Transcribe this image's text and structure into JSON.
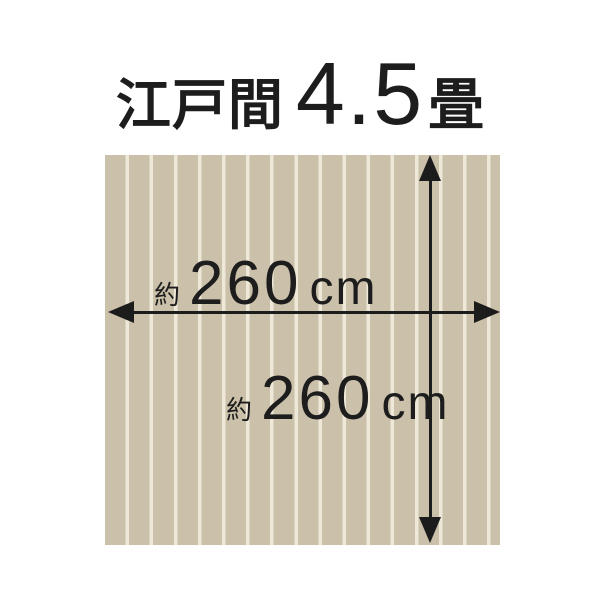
{
  "title": {
    "room_type": "江戸間",
    "size_value": "4.5",
    "size_unit": "畳"
  },
  "dimensions": {
    "width": {
      "approx_prefix": "約",
      "value": "260",
      "unit": "cm"
    },
    "height": {
      "approx_prefix": "約",
      "value": "260",
      "unit": "cm"
    }
  },
  "rug": {
    "base_color": "#cbc1aa",
    "stripe_color": "#eee8d8",
    "panel_count": 16
  },
  "colors": {
    "arrow": "#1c1c1c",
    "text": "#1d1d1d",
    "background": "#ffffff"
  }
}
